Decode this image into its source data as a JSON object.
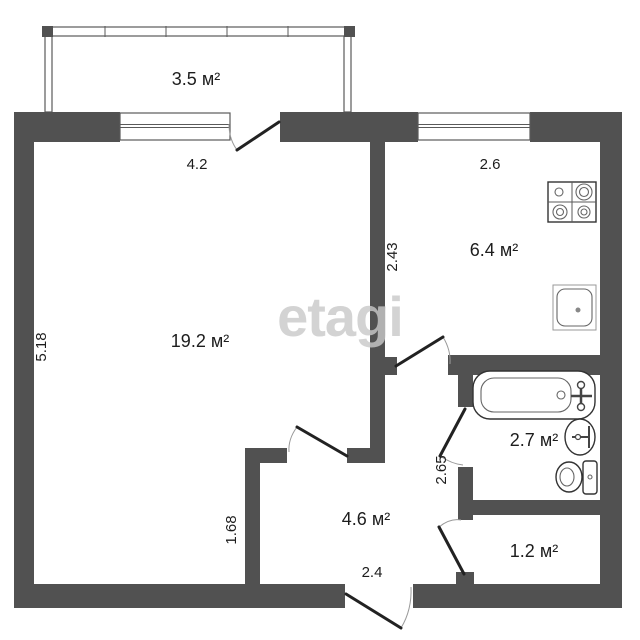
{
  "plan": {
    "watermark": "etagi",
    "units": "м²",
    "rooms": [
      {
        "name": "balcony",
        "label": "3.5 м²"
      },
      {
        "name": "living-room",
        "label": "19.2 м²"
      },
      {
        "name": "kitchen",
        "label": "6.4 м²"
      },
      {
        "name": "bathroom",
        "label": "2.7 м²"
      },
      {
        "name": "hallway",
        "label": "4.6 м²"
      },
      {
        "name": "storage",
        "label": "1.2 м²"
      }
    ],
    "dimensions": [
      {
        "name": "balcony-window-width",
        "label": "4.2"
      },
      {
        "name": "kitchen-width",
        "label": "2.6"
      },
      {
        "name": "living-room-height",
        "label": "5.18"
      },
      {
        "name": "kitchen-height",
        "label": "2.43"
      },
      {
        "name": "living-lower-width",
        "label": "1.68"
      },
      {
        "name": "bathroom-height",
        "label": "2.65"
      },
      {
        "name": "hallway-width",
        "label": "2.4"
      }
    ],
    "fixtures": [
      "stove",
      "kitchen-sink",
      "bathtub",
      "bathroom-sink",
      "toilet"
    ],
    "colors": {
      "wall": "#515151",
      "door-leaf": "#222222",
      "swing-arc": "#999999",
      "label-text": "#1d1d1d",
      "watermark": "#c9c9c9",
      "background": "#ffffff"
    }
  }
}
